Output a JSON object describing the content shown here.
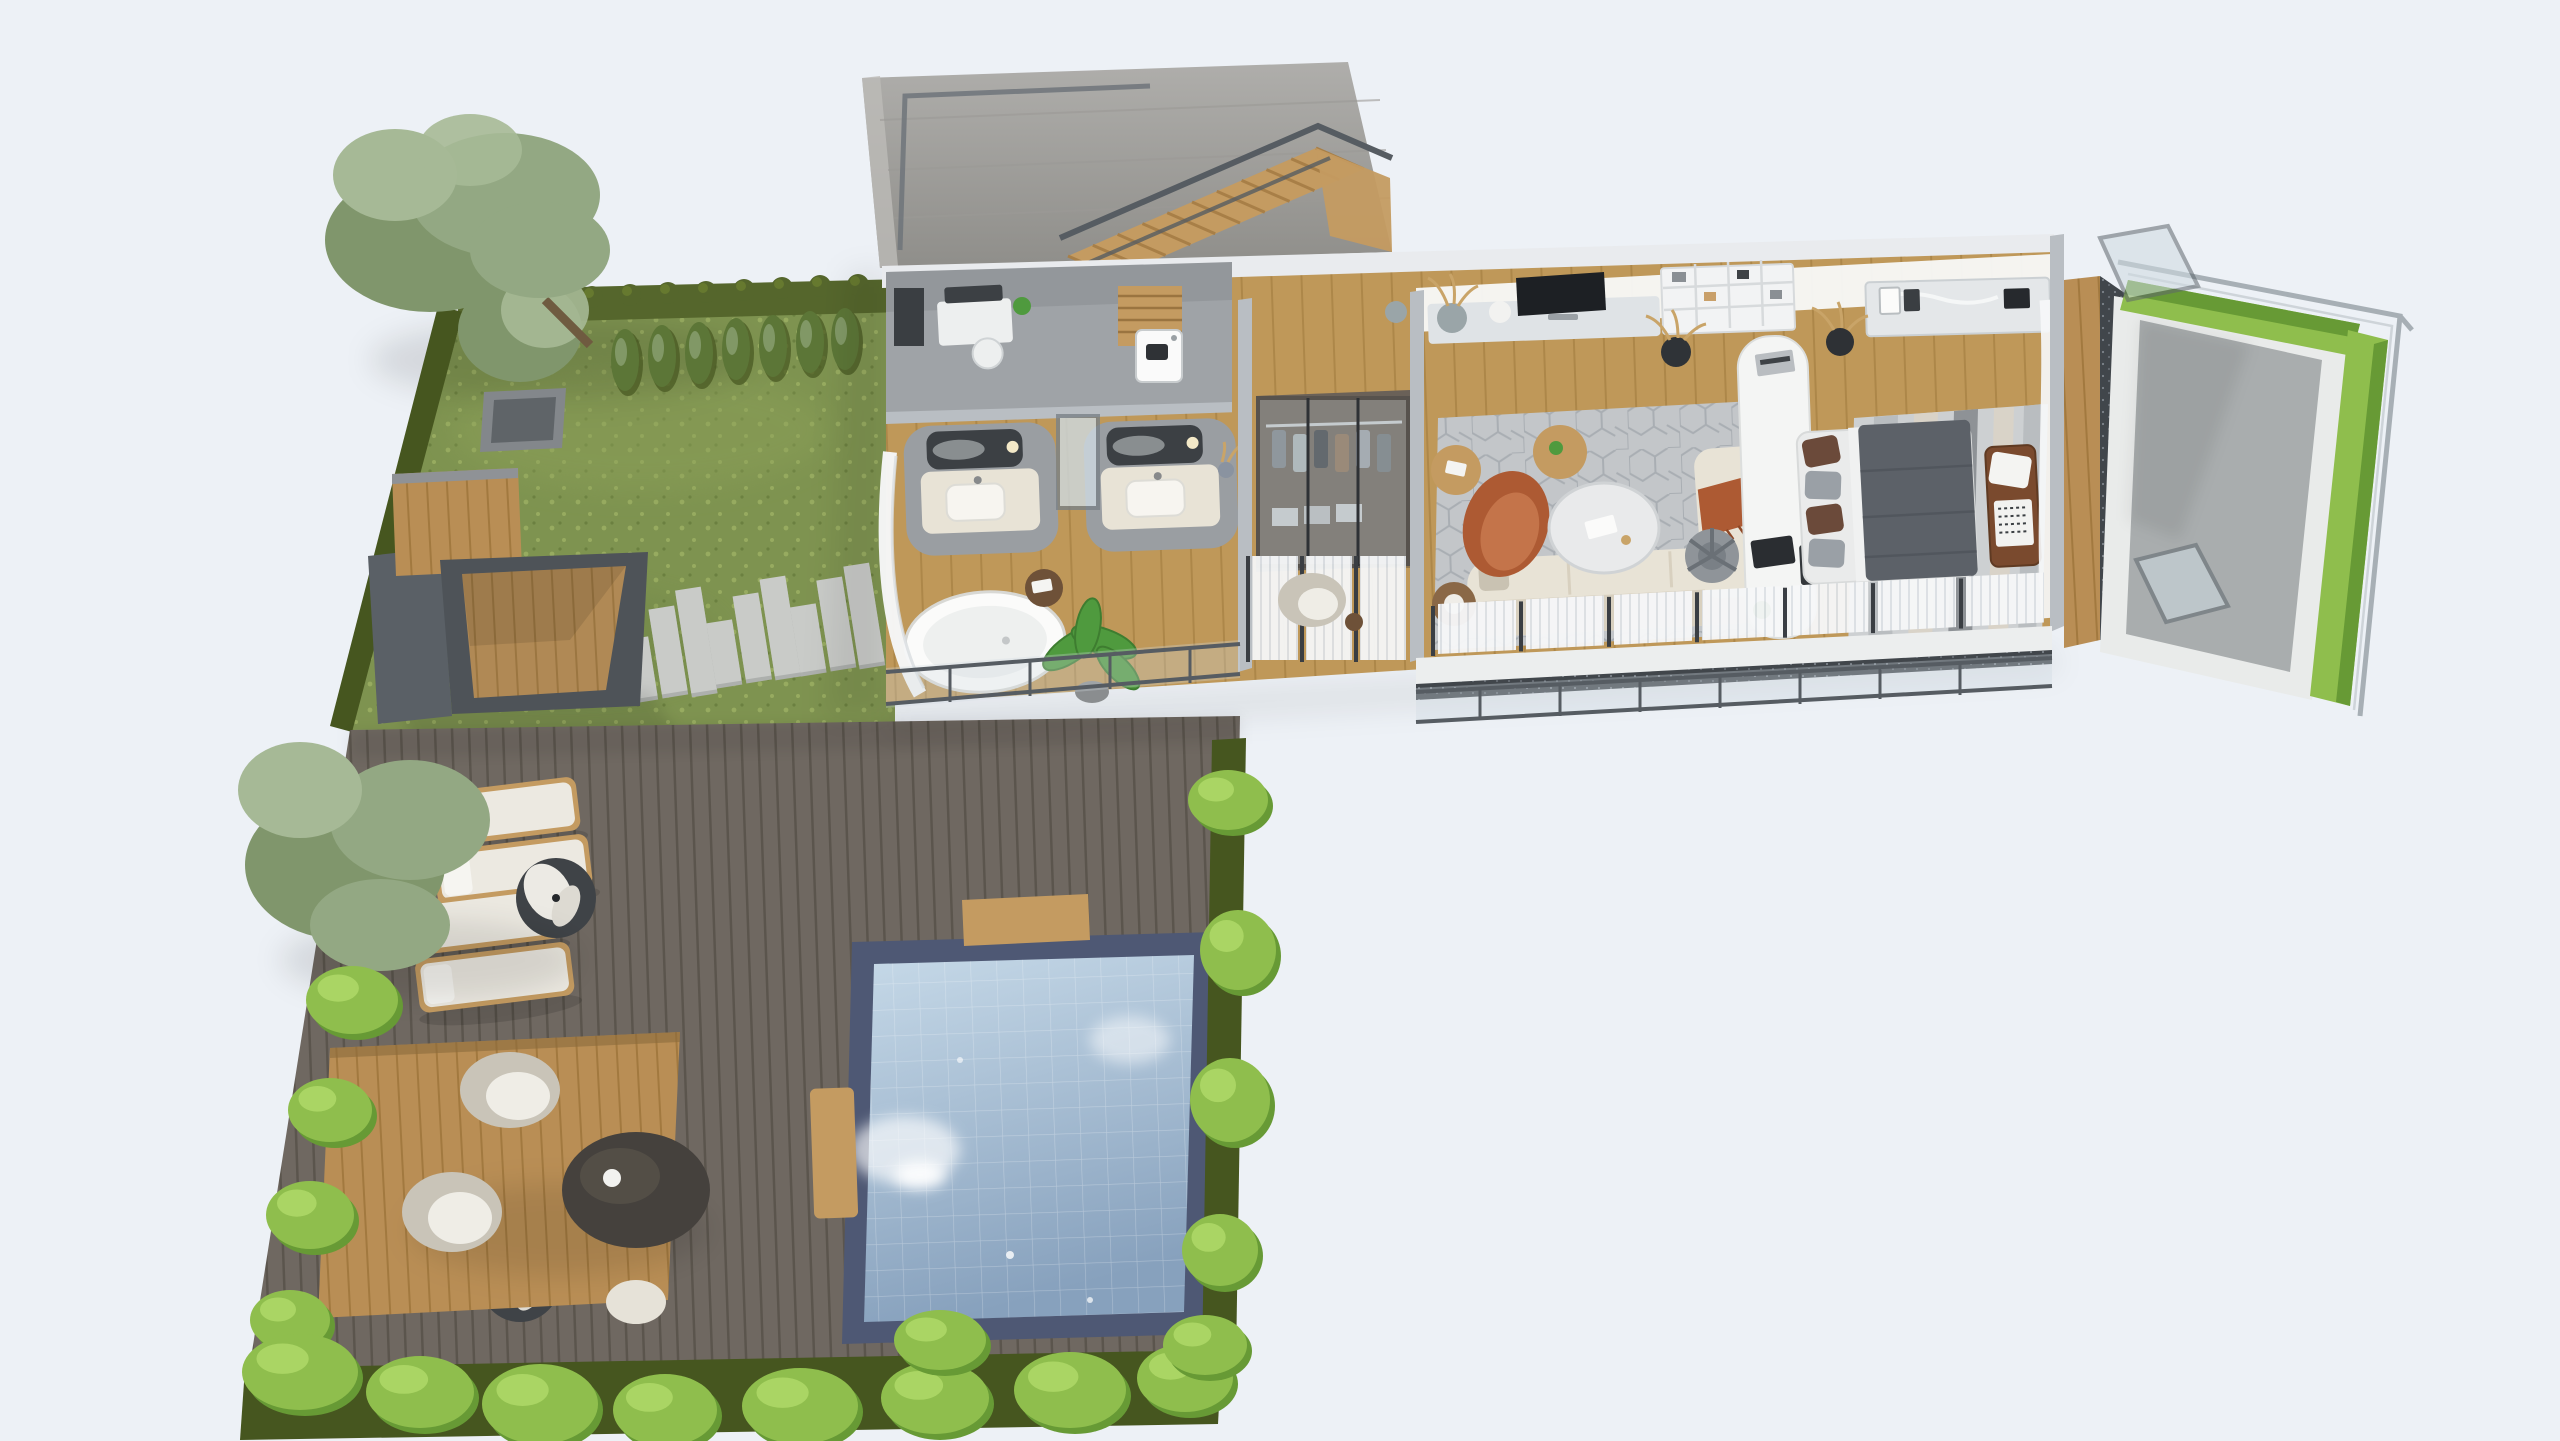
{
  "scene": {
    "type": "3d-isometric-floor-plan-render",
    "background": "#EDF1F6",
    "areas": [
      "garden lawn",
      "wood deck",
      "swimming pool",
      "outdoor lounge platform",
      "pergola lounge",
      "stepping stone path",
      "staircase hall",
      "utility room",
      "bathroom",
      "walk-in closet",
      "living room",
      "workspace",
      "bedroom",
      "balconies",
      "concrete terrace"
    ]
  },
  "palette": {
    "bg": "#EDF1F6",
    "grass": "#7E9350",
    "grassLight": "#97AB60",
    "hedgeDark": "#55662C",
    "hedgeDarker": "#46561F",
    "bushBright": "#8FBE4D",
    "bushShade": "#679A35",
    "bushHi": "#AFD968",
    "conifer": "#5C7637",
    "tree1": "#93A883",
    "tree2": "#80966C",
    "tree3": "#A6B996",
    "trunk": "#6F5B40",
    "woodLight": "#C49B61",
    "woodLightLine": "#A87F47",
    "deck": "#6F6861",
    "deckLine": "#5B554D",
    "platform": "#B98E55",
    "platformLine": "#A2793F",
    "stone": "#C9CBC8",
    "stoneShade": "#ADB0AD",
    "poolBorder": "#4E5874",
    "water1": "#C6D9E8",
    "water2": "#87A1BD",
    "floorWood": "#BF9859",
    "floorWoodLine": "#AD8749",
    "floorGray": "#9FA3A7",
    "concrete1": "#AFAEAB",
    "concrete2": "#8F8E8A",
    "wallFace": "#F8F9F9",
    "wallBand": "#E9EBEE",
    "partition": "#B9BEC3",
    "partitionEdge": "#8E959B",
    "white": "#F4F5F5",
    "cream": "#E8E3D6",
    "creamDark": "#D8D0BF",
    "rust": "#AD5A33",
    "rustLight": "#C4744A",
    "rug": "#C3C6C9",
    "rugDark": "#9EA3A8",
    "rugBed": "#CDD0D2",
    "duvet": "#5C6168",
    "benchBrown": "#7A4A2E",
    "dark": "#2E3135",
    "railing": "#565C62",
    "glass": "#CFDBE2",
    "curtain": "#F6F7F8",
    "curtainLine": "#DDE1E5",
    "fascia": "#ECEEEE",
    "gravel": "#41464B",
    "terrace": "#A9ADAE",
    "curb": "#E9EBEA",
    "mirror": "#3C4044",
    "marble": "#E9EAEB",
    "plantGreen": "#4F9A3E"
  },
  "garden": {
    "conifers": [
      {
        "x": 625,
        "y": 360
      },
      {
        "x": 662,
        "y": 356
      },
      {
        "x": 699,
        "y": 353
      },
      {
        "x": 736,
        "y": 349
      },
      {
        "x": 773,
        "y": 346
      },
      {
        "x": 810,
        "y": 342
      },
      {
        "x": 845,
        "y": 339
      }
    ],
    "hedge_bumps": [
      {
        "x": 478,
        "y": 303
      },
      {
        "x": 516,
        "y": 301
      },
      {
        "x": 554,
        "y": 299
      },
      {
        "x": 592,
        "y": 297
      },
      {
        "x": 630,
        "y": 295
      },
      {
        "x": 668,
        "y": 293
      },
      {
        "x": 706,
        "y": 292
      },
      {
        "x": 744,
        "y": 290
      },
      {
        "x": 782,
        "y": 288
      },
      {
        "x": 820,
        "y": 286
      },
      {
        "x": 858,
        "y": 285
      },
      {
        "x": 893,
        "y": 284
      }
    ],
    "stepping_stones": [
      {
        "x": 612,
        "y": 652,
        "len": 96
      },
      {
        "x": 640,
        "y": 668,
        "len": 60
      },
      {
        "x": 668,
        "y": 650,
        "len": 86
      },
      {
        "x": 696,
        "y": 640,
        "len": 104
      },
      {
        "x": 724,
        "y": 652,
        "len": 62
      },
      {
        "x": 752,
        "y": 636,
        "len": 84
      },
      {
        "x": 780,
        "y": 626,
        "len": 98
      },
      {
        "x": 808,
        "y": 638,
        "len": 66
      },
      {
        "x": 836,
        "y": 622,
        "len": 88
      },
      {
        "x": 864,
        "y": 614,
        "len": 100
      }
    ],
    "bushes_left": [
      {
        "x": 352,
        "y": 1000,
        "rx": 46,
        "ry": 34
      },
      {
        "x": 330,
        "y": 1110,
        "rx": 42,
        "ry": 32
      },
      {
        "x": 310,
        "y": 1215,
        "rx": 44,
        "ry": 34
      },
      {
        "x": 290,
        "y": 1320,
        "rx": 40,
        "ry": 30
      }
    ],
    "bushes_bottom": [
      {
        "x": 300,
        "y": 1372,
        "rx": 58,
        "ry": 38
      },
      {
        "x": 420,
        "y": 1392,
        "rx": 54,
        "ry": 36
      },
      {
        "x": 540,
        "y": 1404,
        "rx": 58,
        "ry": 40
      },
      {
        "x": 665,
        "y": 1410,
        "rx": 52,
        "ry": 36
      },
      {
        "x": 800,
        "y": 1406,
        "rx": 58,
        "ry": 38
      },
      {
        "x": 935,
        "y": 1398,
        "rx": 54,
        "ry": 36
      },
      {
        "x": 1070,
        "y": 1390,
        "rx": 56,
        "ry": 38
      },
      {
        "x": 1185,
        "y": 1378,
        "rx": 48,
        "ry": 34
      }
    ],
    "bushes_right": [
      {
        "x": 1228,
        "y": 800,
        "rx": 40,
        "ry": 30
      },
      {
        "x": 1238,
        "y": 950,
        "rx": 38,
        "ry": 40
      },
      {
        "x": 1230,
        "y": 1100,
        "rx": 40,
        "ry": 42
      },
      {
        "x": 1220,
        "y": 1250,
        "rx": 38,
        "ry": 36
      },
      {
        "x": 1205,
        "y": 1345,
        "rx": 42,
        "ry": 30
      },
      {
        "x": 940,
        "y": 1340,
        "rx": 46,
        "ry": 30
      }
    ]
  },
  "deck": {
    "loungers": [
      {
        "x": 420,
        "y": 795,
        "rot": -7
      },
      {
        "x": 432,
        "y": 852,
        "rot": -7
      },
      {
        "x": 402,
        "y": 903,
        "rot": -7
      },
      {
        "x": 414,
        "y": 960,
        "rot": -7
      }
    ],
    "parasols_folded": [
      {
        "x": 556,
        "y": 898
      },
      {
        "x": 520,
        "y": 1282
      }
    ]
  },
  "house": {
    "stairs": {
      "x1": 1068,
      "y1": 256,
      "x2": 1316,
      "y2": 148,
      "wx": 48,
      "wy": 21,
      "steps": 10
    },
    "south_windows": {
      "x0": 1438,
      "y0": 604,
      "slope": -0.052,
      "panel_w": 78,
      "gap": 10,
      "count": 7,
      "h": 50
    },
    "closet_clothes": {
      "x0": 1272,
      "y": 430,
      "w": 14,
      "gap": 7,
      "colors": [
        "#7A8288",
        "#A9B2B5",
        "#3C3F44",
        "#8A6F55",
        "#9AA0A6",
        "#6E7579"
      ]
    },
    "bath_curtains": [
      {
        "x": 1252
      },
      {
        "x": 1306
      },
      {
        "x": 1360
      }
    ]
  }
}
